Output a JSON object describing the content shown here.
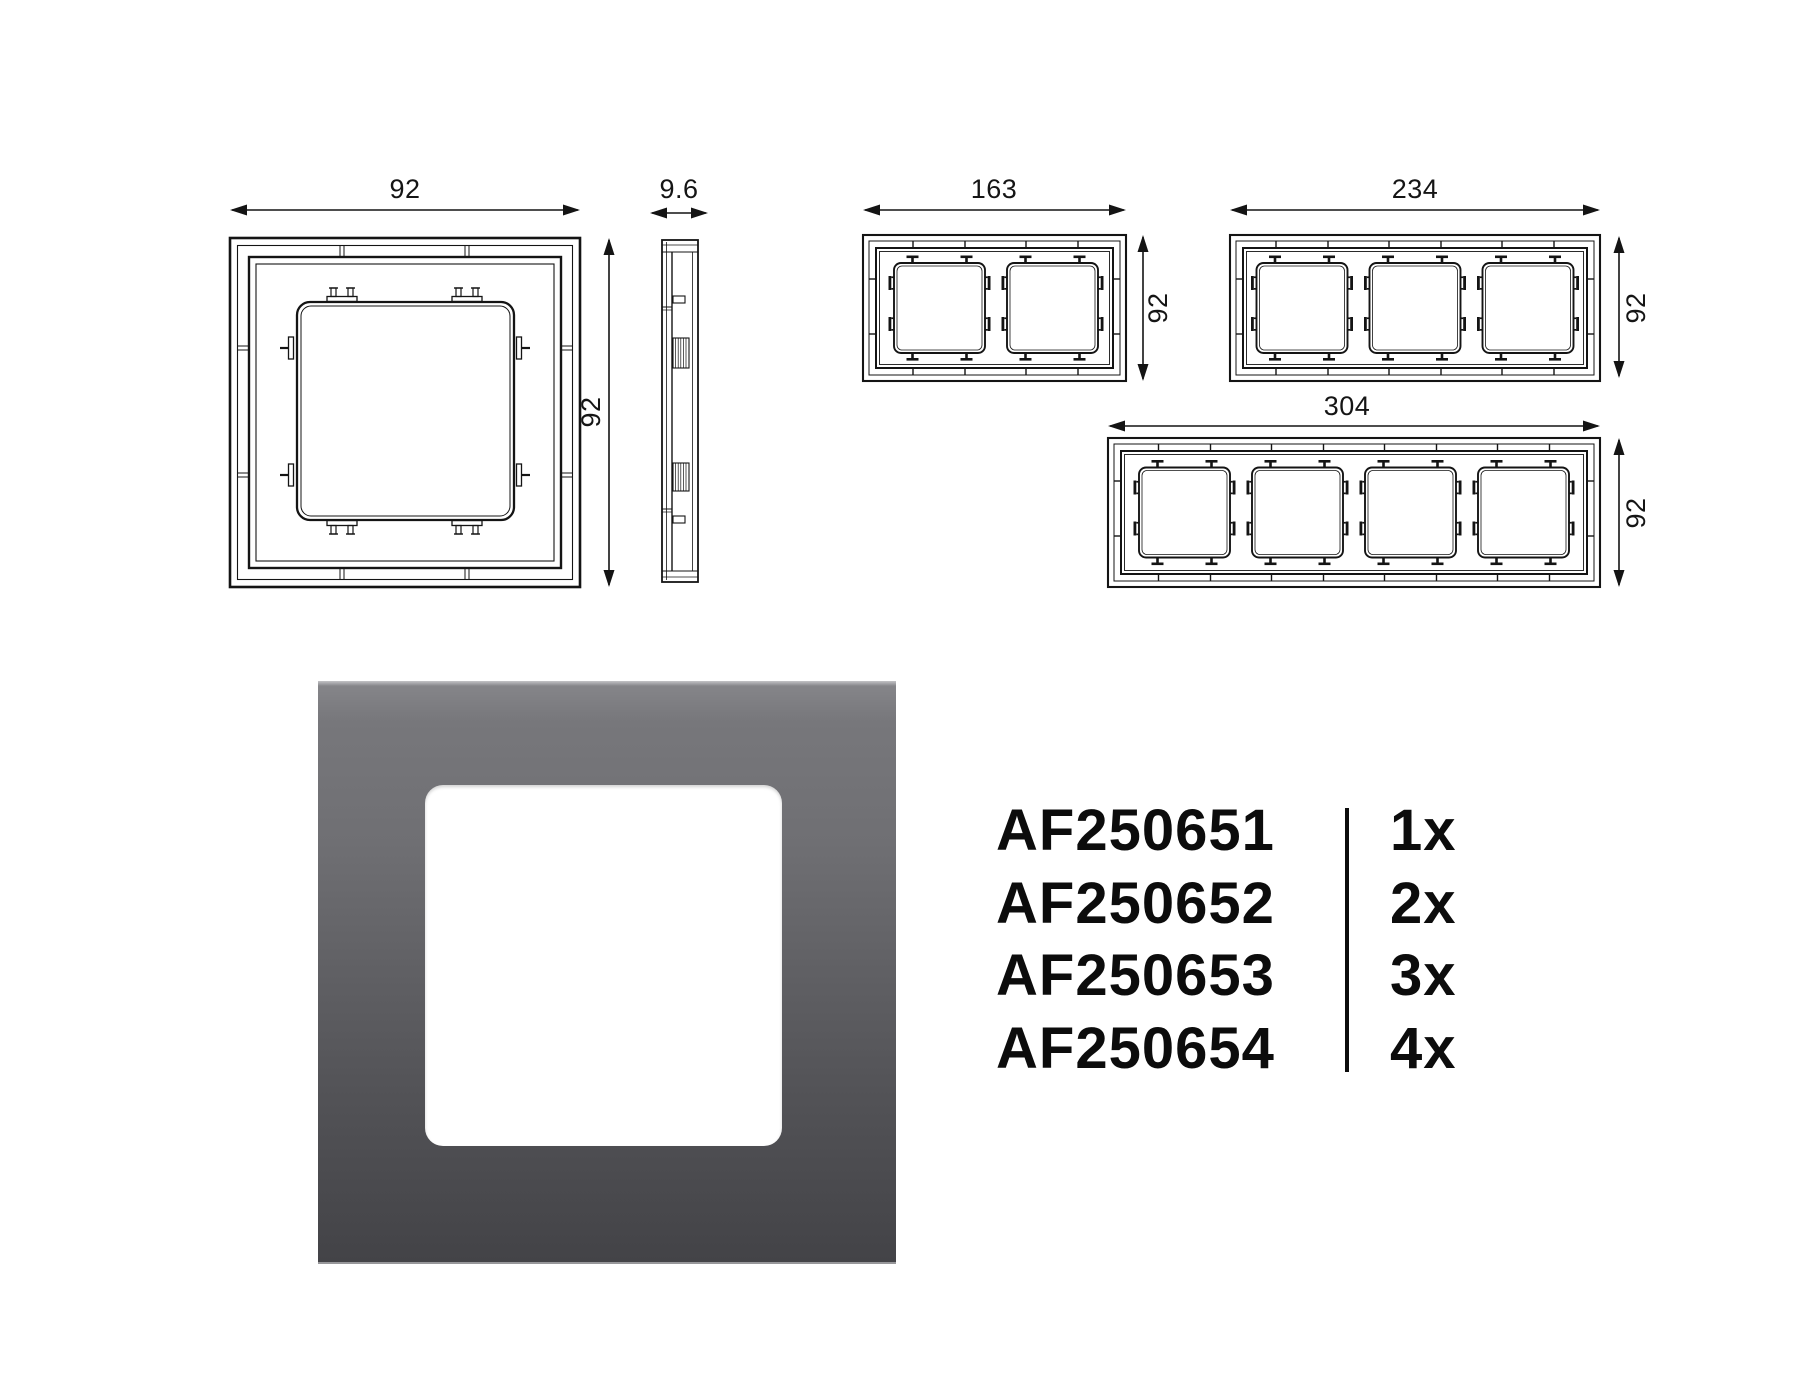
{
  "dims": {
    "single_width": "92",
    "single_height": "92",
    "depth": "9.6",
    "two_gang_width": "163",
    "two_gang_height": "92",
    "three_gang_width": "234",
    "three_gang_height": "92",
    "four_gang_width": "304",
    "four_gang_height": "92"
  },
  "products": [
    {
      "code": "AF250651",
      "qty": "1x"
    },
    {
      "code": "AF250652",
      "qty": "2x"
    },
    {
      "code": "AF250653",
      "qty": "3x"
    },
    {
      "code": "AF250654",
      "qty": "4x"
    }
  ],
  "colors": {
    "line": "#141414",
    "frame_top": "#78787b",
    "frame_bottom": "#434346",
    "window": "#ffffff"
  }
}
